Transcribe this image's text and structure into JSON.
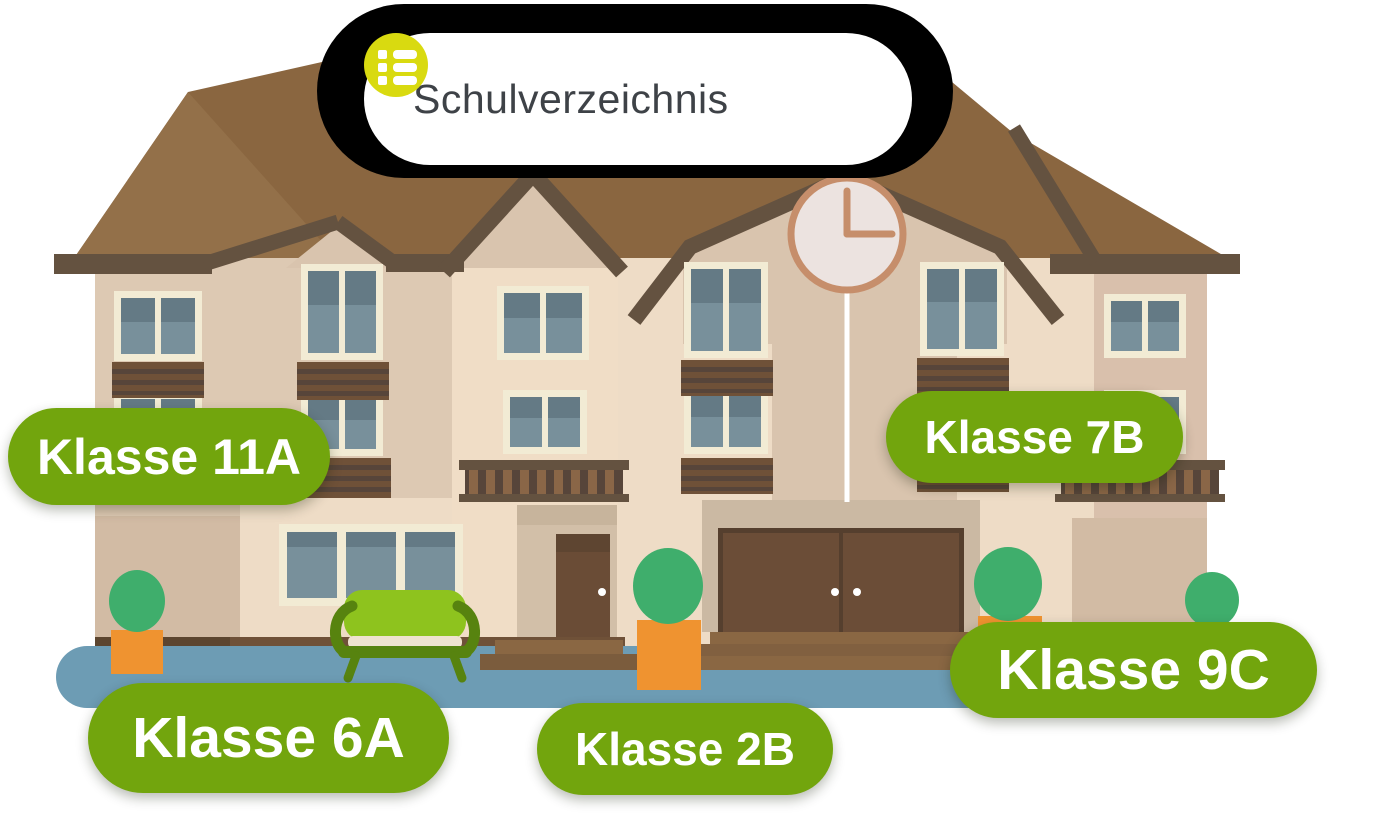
{
  "header": {
    "title": "Schulverzeichnis",
    "icon": "list-icon"
  },
  "class_labels": [
    {
      "text": "Klasse 11A"
    },
    {
      "text": "Klasse 7B"
    },
    {
      "text": "Klasse 6A"
    },
    {
      "text": "Klasse 2B"
    },
    {
      "text": "Klasse 9C"
    }
  ],
  "colors": {
    "label_green": "#72a50d",
    "icon_yellow": "#d9da10",
    "title_text": "#3e4247",
    "header_shadow": "#000000",
    "roof_brown": "#8a6640",
    "wall_beige": "#eedcc6",
    "trim_brown": "#645240",
    "window_blue": "#78909b",
    "walkway_blue": "#6d9cb4",
    "bush_green": "#3fae6c",
    "planter_orange": "#ef9330",
    "bench_green": "#8ec31e",
    "clock_copper": "#c68e6b"
  }
}
